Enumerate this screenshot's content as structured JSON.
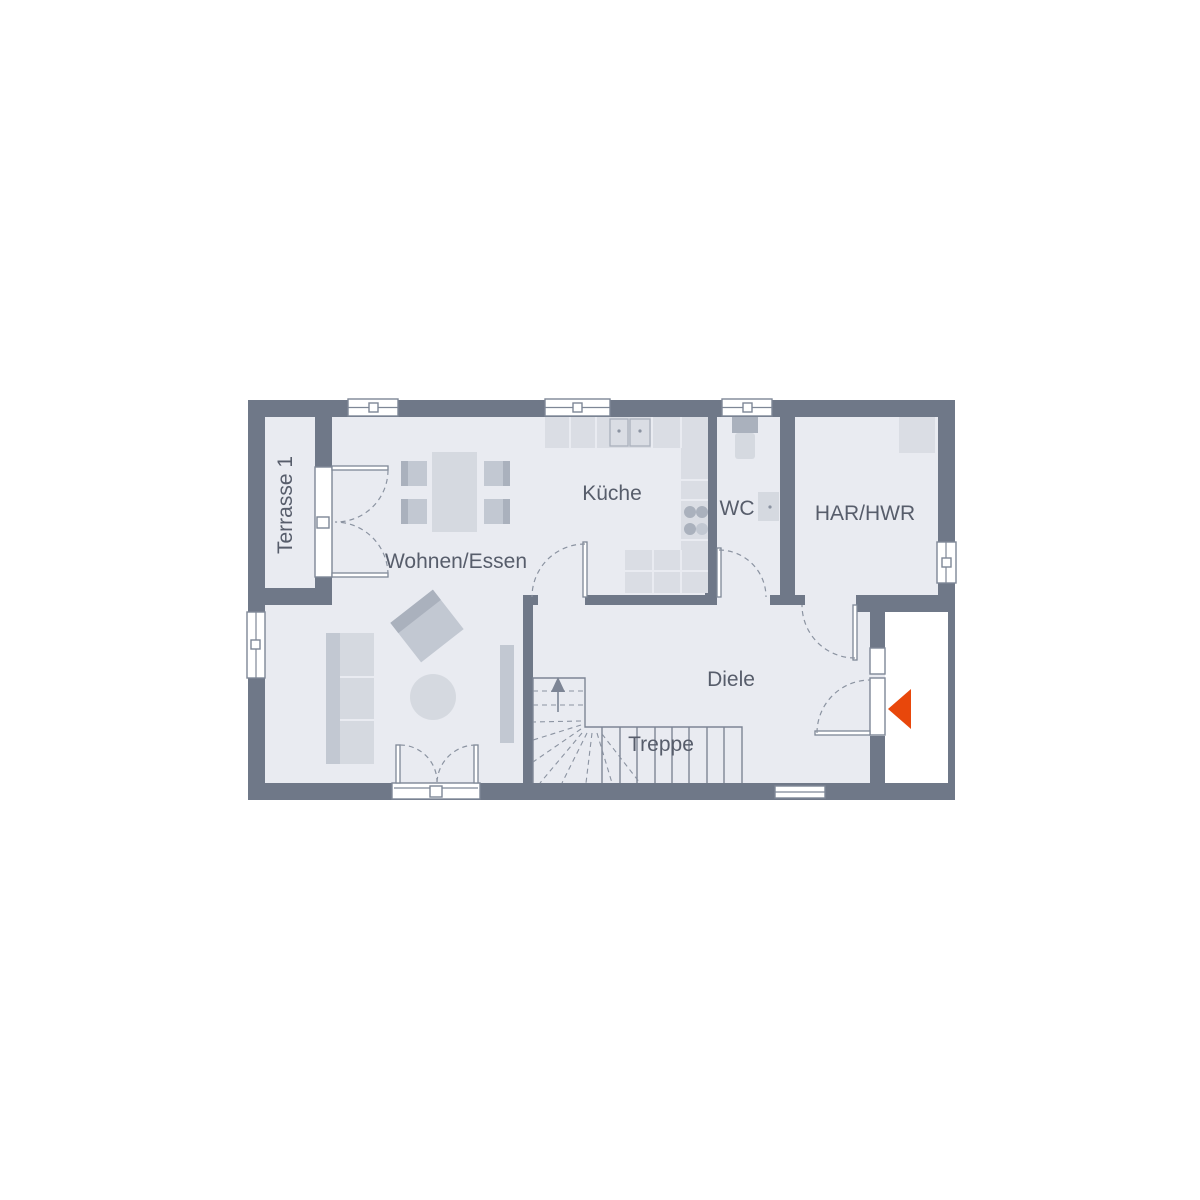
{
  "rooms": {
    "terrasse": {
      "label": "Terrasse 1"
    },
    "wohnen_essen": {
      "label": "Wohnen/Essen"
    },
    "kueche": {
      "label": "Küche"
    },
    "wc": {
      "label": "WC"
    },
    "har_hwr": {
      "label": "HAR/HWR"
    },
    "diele": {
      "label": "Diele"
    },
    "treppe": {
      "label": "Treppe"
    }
  },
  "colors": {
    "wall": "#6f7888",
    "floor": "#e9ebf1",
    "outside": "#ffffff",
    "line": "#7e8796",
    "dash": "#8b93a1",
    "stair_line": "#7d8595",
    "furniture": "#d5d9e0",
    "furniture_mid": "#c2c8d2",
    "furniture_dark": "#aab1bd",
    "counter": "#dadde4",
    "accent": "#e8470b",
    "label_text": "#575d6b"
  }
}
